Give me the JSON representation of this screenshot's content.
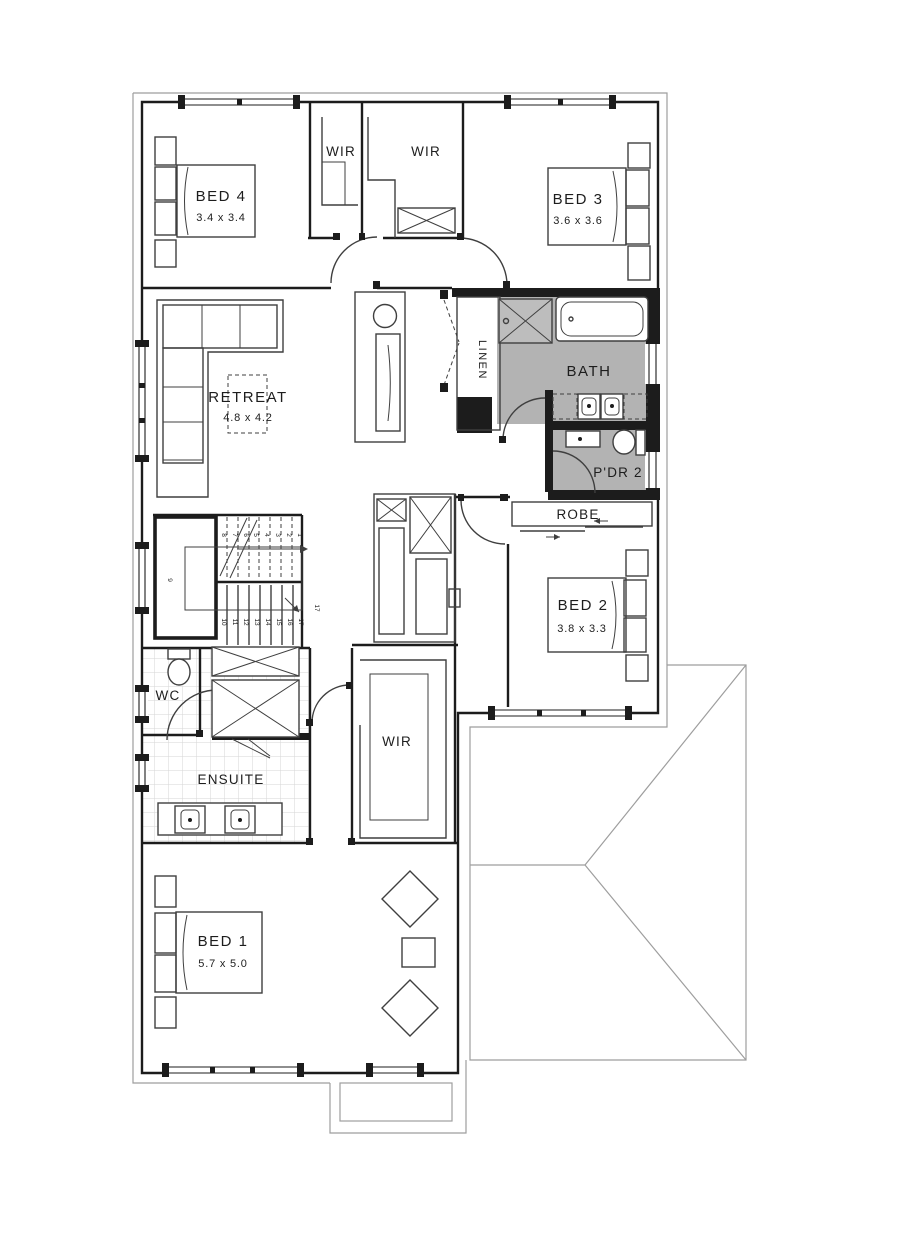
{
  "plan": {
    "rooms": {
      "bed4": {
        "label": "BED 4",
        "dims": "3.4 x 3.4"
      },
      "wir_left": {
        "label": "WIR"
      },
      "wir_right": {
        "label": "WIR"
      },
      "bed3": {
        "label": "BED 3",
        "dims": "3.6 x 3.6"
      },
      "retreat": {
        "label": "RETREAT",
        "dims": "4.8 x 4.2"
      },
      "linen": {
        "label": "LINEN"
      },
      "bath": {
        "label": "BATH"
      },
      "pdr2": {
        "label": "P'DR 2"
      },
      "robe": {
        "label": "ROBE"
      },
      "bed2": {
        "label": "BED 2",
        "dims": "3.8 x 3.3"
      },
      "wc": {
        "label": "WC"
      },
      "ensuite": {
        "label": "ENSUITE"
      },
      "wir_master": {
        "label": "WIR"
      },
      "bed1": {
        "label": "BED 1",
        "dims": "5.7 x 5.0"
      }
    },
    "stairs": {
      "steps": [
        "1",
        "2",
        "3",
        "4",
        "5",
        "6",
        "7",
        "8",
        "9",
        "10",
        "11",
        "12",
        "13",
        "14",
        "15",
        "16",
        "17"
      ]
    },
    "colors": {
      "wall": "#1c1c1c",
      "line": "#3f3f3f",
      "wet_area_fill": "#b3b3b3",
      "tile_line": "#d6d6d6",
      "eave": "#9e9e9e",
      "text": "#1d1d1d"
    }
  }
}
